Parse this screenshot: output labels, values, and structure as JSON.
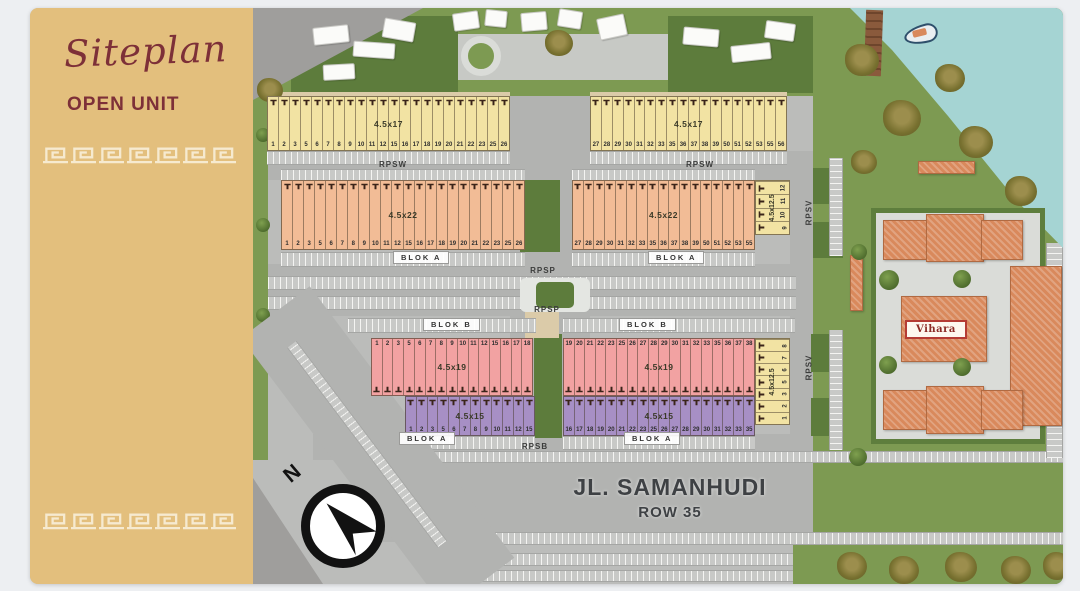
{
  "slide": {
    "title": "Siteplan",
    "subtitle": "OPEN UNIT"
  },
  "colors": {
    "sidebar_bg": "#e3bf7d",
    "accent_maroon": "#7d3038",
    "pattern_cream": "#f6ead0",
    "grass": "#7d9a52",
    "water": "#a5d4d3",
    "road_gray": "#b2b3b1",
    "roof_orange": "#d9895c",
    "unit_yellow": "#f2e3a3",
    "unit_orange": "#f2bc96",
    "unit_pink": "#f2a2a2",
    "unit_purple": "#a78fc5"
  },
  "map": {
    "street": {
      "name": "JL. SAMANHUDI",
      "row_label": "ROW 35"
    },
    "compass": {
      "label": "N"
    },
    "landmark": {
      "vihara": "Vihara"
    },
    "road_labels": {
      "rpsw_left": "RPSW",
      "rpsw_right": "RPSW",
      "rpsp_top": "RPSP",
      "rpsp_bottom": "RPSP",
      "rpsb": "RPSB",
      "rpsv_top": "RPSV",
      "rpsv_bottom": "RPSV"
    },
    "block_labels": {
      "blok_a_top_left": "BLOK A",
      "blok_a_top_right": "BLOK A",
      "blok_b_left": "BLOK B",
      "blok_b_right": "BLOK B",
      "blok_a_bottom_left": "BLOK A",
      "blok_a_bottom_right": "BLOK A"
    },
    "strips": [
      {
        "id": "yellow-left",
        "size_label": "4.5x17",
        "color": "#f2e3a3",
        "number_pos": "bottom",
        "orientation": "h",
        "numbers": [
          1,
          2,
          3,
          5,
          6,
          7,
          8,
          9,
          10,
          11,
          12,
          15,
          16,
          17,
          18,
          19,
          20,
          21,
          22,
          23,
          25,
          26
        ]
      },
      {
        "id": "yellow-right",
        "size_label": "4.5x17",
        "color": "#f2e3a3",
        "number_pos": "bottom",
        "orientation": "h",
        "numbers": [
          27,
          28,
          29,
          30,
          31,
          32,
          33,
          35,
          36,
          37,
          38,
          39,
          50,
          51,
          52,
          53,
          55,
          56
        ]
      },
      {
        "id": "orange-left",
        "size_label": "4.5x22",
        "color": "#f2bc96",
        "number_pos": "bottom",
        "orientation": "h",
        "numbers": [
          1,
          2,
          3,
          5,
          6,
          7,
          8,
          9,
          10,
          11,
          12,
          15,
          16,
          17,
          18,
          19,
          20,
          21,
          22,
          23,
          25,
          26
        ]
      },
      {
        "id": "orange-right",
        "size_label": "4.5x22",
        "color": "#f2bc96",
        "number_pos": "bottom",
        "orientation": "h",
        "numbers": [
          27,
          28,
          29,
          30,
          31,
          32,
          33,
          35,
          36,
          37,
          38,
          39,
          50,
          51,
          52,
          53,
          55
        ]
      },
      {
        "id": "pink-left",
        "size_label": "4.5x19",
        "color": "#f2a2a2",
        "number_pos": "top",
        "orientation": "h",
        "numbers": [
          1,
          2,
          3,
          5,
          6,
          7,
          8,
          9,
          10,
          11,
          12,
          15,
          16,
          17,
          18
        ]
      },
      {
        "id": "pink-right",
        "size_label": "4.5x19",
        "color": "#f2a2a2",
        "number_pos": "top",
        "orientation": "h",
        "numbers": [
          19,
          20,
          21,
          22,
          23,
          25,
          26,
          27,
          28,
          29,
          30,
          31,
          32,
          33,
          35,
          36,
          37,
          38
        ]
      },
      {
        "id": "purple-left",
        "size_label": "4.5x15",
        "color": "#a78fc5",
        "number_pos": "bottom",
        "orientation": "h",
        "numbers": [
          1,
          2,
          3,
          5,
          6,
          7,
          8,
          9,
          10,
          11,
          12,
          15
        ]
      },
      {
        "id": "purple-right",
        "size_label": "4.5x15",
        "color": "#a78fc5",
        "number_pos": "bottom",
        "orientation": "h",
        "numbers": [
          16,
          17,
          18,
          19,
          20,
          21,
          22,
          23,
          25,
          26,
          27,
          28,
          29,
          30,
          31,
          32,
          33,
          35
        ]
      },
      {
        "id": "side-top",
        "size_label": "4.5x12.5",
        "color": "#f2e3a3",
        "number_pos": "bottom",
        "orientation": "v",
        "numbers": [
          9,
          10,
          11,
          12
        ]
      },
      {
        "id": "side-bottom",
        "size_label": "4.5x12.5",
        "color": "#f2e3a3",
        "number_pos": "bottom",
        "orientation": "v",
        "numbers": [
          1,
          2,
          3,
          5,
          6,
          7,
          8
        ]
      }
    ]
  }
}
